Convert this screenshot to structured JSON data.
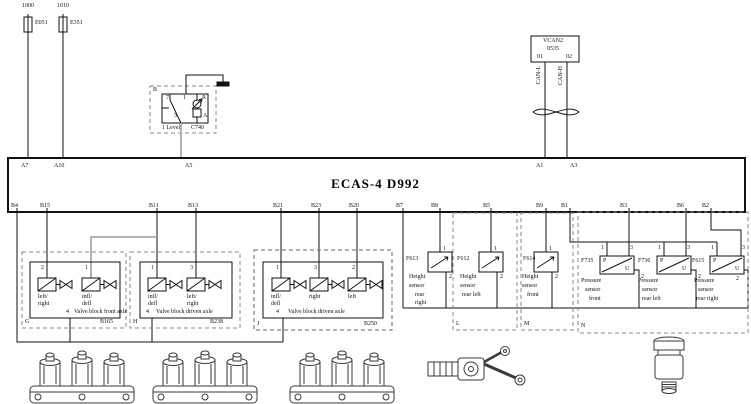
{
  "colors": {
    "line": "#111111",
    "gray_wire": "#aaaaaa",
    "dashed_box": "#888888",
    "illustration": "#3a3a3a"
  },
  "power": {
    "circuits": [
      {
        "wire": "1000",
        "fuse": "E051"
      },
      {
        "wire": "1010",
        "fuse": "E351"
      }
    ]
  },
  "level_switch": {
    "corner": "B",
    "pin7": "7",
    "pin1": "1",
    "pinR": "R",
    "pin5": "5",
    "pinA": "A",
    "name": "1 Level",
    "code": "C740"
  },
  "vcan": {
    "title": "VCAN2",
    "code": "0535",
    "pin1": "01",
    "pin2": "02",
    "can_l": "CAN-L",
    "can_h": "CAN-H"
  },
  "ecu": {
    "title": "ECAS-4  D992",
    "top_pins": [
      "A7",
      "A10",
      "A5",
      "A1",
      "A3"
    ],
    "bottom_pins": [
      "B4",
      "B15",
      "B11",
      "B13",
      "B21",
      "B23",
      "B20",
      "B7",
      "B8",
      "B5",
      "B9",
      "B1",
      "B3",
      "B6",
      "B2"
    ]
  },
  "valve_blocks": [
    {
      "corner": "G",
      "code": "B165",
      "pin_a": "2",
      "pin_b": "1",
      "ground_pin": "4",
      "valve1": [
        "left/",
        "right"
      ],
      "valve2": [
        "infl/",
        "defl"
      ],
      "title": "Valve block front axle"
    },
    {
      "corner": "H",
      "code": "B238",
      "pin_a": "1",
      "pin_b": "3",
      "ground_pin": "4",
      "valve1": [
        "infl/",
        "defl"
      ],
      "valve2": [
        "left/",
        "right"
      ],
      "title": "Valve block driven axle"
    },
    {
      "corner": "J",
      "code": "B250",
      "pin_a": "1",
      "pin_b": "3",
      "pin_c": "2",
      "ground_pin": "4",
      "valve1": [
        "infl/",
        "defl"
      ],
      "valve2": [
        "right"
      ],
      "valve3": [
        "left"
      ],
      "title": "Valve block driven axle"
    }
  ],
  "height_sensors": [
    {
      "code": "F613",
      "pin1": "1",
      "pin2": "2",
      "name_lines": [
        "Height",
        "sensor",
        "rear",
        "right"
      ]
    },
    {
      "code": "F612",
      "corner": "L",
      "pin1": "1",
      "pin2": "2",
      "name_lines": [
        "Height",
        "sensor",
        "rear left"
      ]
    },
    {
      "code": "F614",
      "corner": "M",
      "pin1": "1",
      "pin2": "2",
      "name_lines": [
        "Height",
        "sensor",
        "front"
      ]
    }
  ],
  "pressure_sensors": {
    "corner": "N",
    "items": [
      {
        "code": "F735",
        "pin1": "1",
        "pin3": "3",
        "pin2": "2",
        "sym_p": "P",
        "sym_u": "U",
        "name_lines": [
          "Pressure",
          "sensor",
          "front"
        ]
      },
      {
        "code": "F736",
        "pin1": "1",
        "pin3": "3",
        "pin2": "2",
        "sym_p": "P",
        "sym_u": "U",
        "name_lines": [
          "Pressure",
          "sensor",
          "rear left"
        ]
      },
      {
        "code": "F615",
        "pin1": "1",
        "pin3": "3",
        "pin2": "2",
        "sym_p": "P",
        "sym_u": "U",
        "name_lines": [
          "Pressure",
          "sensor",
          "rear right"
        ]
      }
    ]
  },
  "illustrations": {
    "items": [
      "valve-block-manifold",
      "valve-block-manifold",
      "valve-block-manifold",
      "height-sensor-device",
      "pressure-sensor-device"
    ]
  }
}
